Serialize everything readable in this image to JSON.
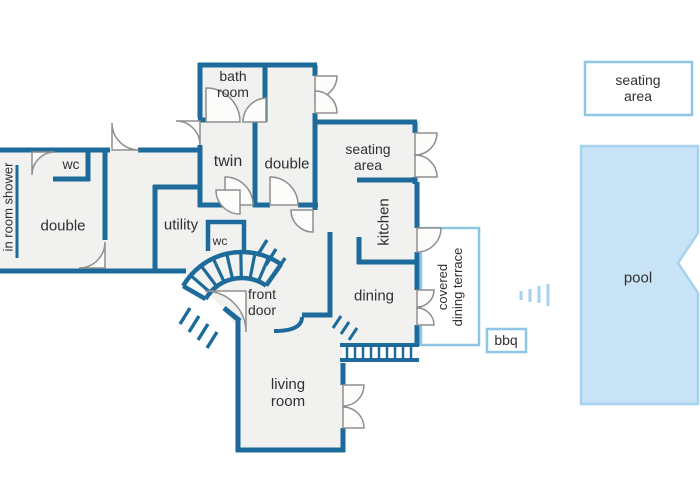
{
  "title": "floor plan",
  "colors": {
    "wall": "#1d6b9a",
    "room_fill": "#f1f1ef",
    "outdoor_accent": "#8ec7e6",
    "pool_fill": "#c9e3f6",
    "pool_border": "#a5d2ee",
    "door_arc": "#8f8f8f",
    "label_text": "#303030"
  },
  "rooms": {
    "bathroom": "bath\nroom",
    "twin": "twin",
    "double_top": "double",
    "seating_indoor": "seating\narea",
    "wc_left": "wc",
    "double_left": "double",
    "in_room_shower": "in room shower",
    "utility": "utility",
    "wc_hall": "wc",
    "kitchen": "kitchen",
    "front_door": "front\ndoor",
    "dining": "dining",
    "covered_terrace": "covered\ndining terrace",
    "living_room": "living\nroom",
    "bbq": "bbq",
    "seating_outdoor": "seating\narea",
    "pool": "pool"
  }
}
